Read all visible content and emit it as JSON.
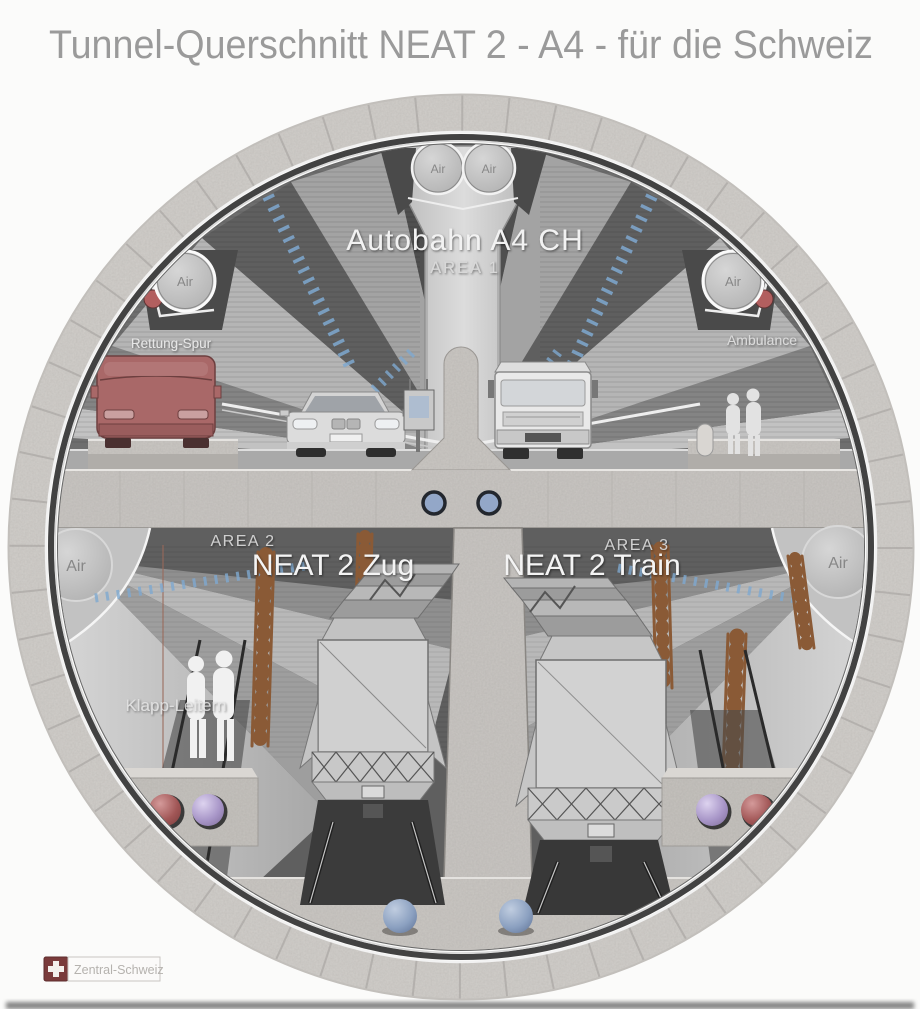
{
  "title": "Tunnel-Querschnitt NEAT 2 - A4 - für die Schweiz",
  "labels": {
    "autobahn": "Autobahn A4 CH",
    "area1": "AREA 1",
    "rescue_lane": "Rettung-Spur",
    "ambulance": "Ambulance",
    "area2": "AREA 2",
    "neat_zug": "NEAT 2 Zug",
    "area3": "AREA 3",
    "neat_train": "NEAT 2 Train",
    "klapp_leitern": "Klapp-Leitern",
    "air": "Air",
    "badge": "Zentral-Schweiz"
  },
  "colors": {
    "title_gray": "#9a9a9a",
    "van_red": "#a96868",
    "dot_red": "#b25f5f",
    "sphere_red_mid": "#a15656",
    "sphere_purple_mid": "#a795c7",
    "sphere_blue_mid": "#8ba0c0",
    "porthole_blue": "#93a7c8",
    "dash_blue": "#7fa9d0",
    "swiss_red": "#7a3b3b",
    "concrete": "#ccc9c5"
  }
}
